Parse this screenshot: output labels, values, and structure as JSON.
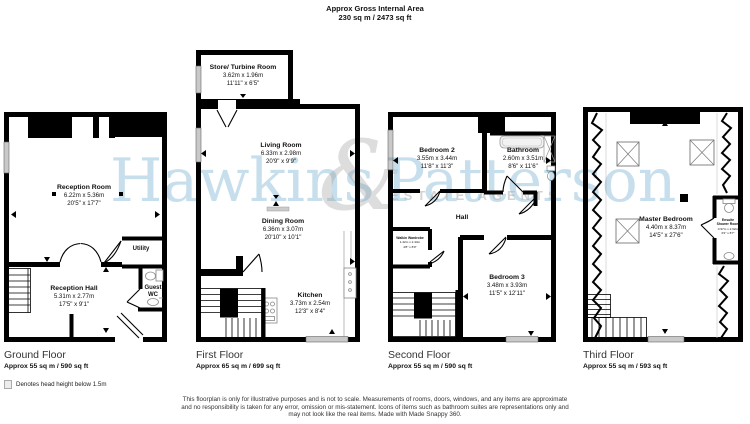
{
  "header": {
    "line1": "Approx Gross Internal Area",
    "line2": "230 sq m / 2473 sq ft"
  },
  "watermark": {
    "word1": "Hawkins",
    "word2": "Patterson",
    "ampersand": "&",
    "subtitle": "ESTATE AGENTS",
    "accent_color": "#a4cbe1",
    "gray_color": "#bdbdbd"
  },
  "icons": [
    "toilet-icon",
    "sink-icon",
    "bath-icon",
    "shower-icon",
    "skylight-icon",
    "stairs-icon",
    "window-marker",
    "door-arc",
    "hob-icon",
    "oven-icon"
  ],
  "floors": [
    {
      "title": "Ground Floor",
      "area": "Approx 55 sq m / 590 sq ft",
      "rooms": [
        {
          "name": "Reception Room",
          "metric": "6.22m x 5.36m",
          "imperial": "20'5\" x 17'7\""
        },
        {
          "name": "Reception Hall",
          "metric": "5.31m x 2.77m",
          "imperial": "17'5\" x 9'1\""
        },
        {
          "name": "Utility"
        },
        {
          "name": "Guest WC"
        }
      ]
    },
    {
      "title": "First Floor",
      "area": "Approx 65 sq m / 699 sq ft",
      "rooms": [
        {
          "name": "Store/ Turbine Room",
          "metric": "3.62m x 1.96m",
          "imperial": "11'11\" x 6'5\""
        },
        {
          "name": "Living Room",
          "metric": "6.33m x 2.98m",
          "imperial": "20'9\" x 9'9\""
        },
        {
          "name": "Dining Room",
          "metric": "6.36m x 3.07m",
          "imperial": "20'10\" x 10'1\""
        },
        {
          "name": "Kitchen",
          "metric": "3.73m x 2.54m",
          "imperial": "12'3\" x 8'4\""
        }
      ]
    },
    {
      "title": "Second Floor",
      "area": "Approx 55 sq m / 590 sq ft",
      "rooms": [
        {
          "name": "Bedroom 2",
          "metric": "3.55m x 3.44m",
          "imperial": "11'8\" x 11'3\""
        },
        {
          "name": "Bathroom",
          "metric": "2.60m x 3.51m",
          "imperial": "8'6\" x 11'6\""
        },
        {
          "name": "Hall"
        },
        {
          "name": "Walkin Wardrobe",
          "metric": "1.42m x 2.44m",
          "imperial": "4'8\" x 8'0\""
        },
        {
          "name": "Bedroom 3",
          "metric": "3.48m x 3.93m",
          "imperial": "11'5\" x 12'11\""
        }
      ]
    },
    {
      "title": "Third Floor",
      "area": "Approx 55 sq m / 593 sq ft",
      "rooms": [
        {
          "name": "Master Bedroom",
          "metric": "4.40m x 8.37m",
          "imperial": "14'5\" x 27'6\""
        },
        {
          "name": "Ensuite Shower Room",
          "line1": "Ensuite",
          "line2": "Shower Room",
          "metric": "0.97m x 2.62m",
          "imperial": "3'2\" x 8'7\""
        }
      ]
    }
  ],
  "legend": {
    "text": "Denotes head height below 1.5m"
  },
  "disclaimer": {
    "line1": "This floorplan is only for illustrative purposes and is not to scale. Measurements of rooms, doors, windows, and any items are approximate",
    "line2": "and no responsibility is taken for any error, omission or mis-statement. Icons of items such as bathroom suites are representations only and",
    "line3": "may not look like the real items. Made with Made Snappy 360."
  }
}
